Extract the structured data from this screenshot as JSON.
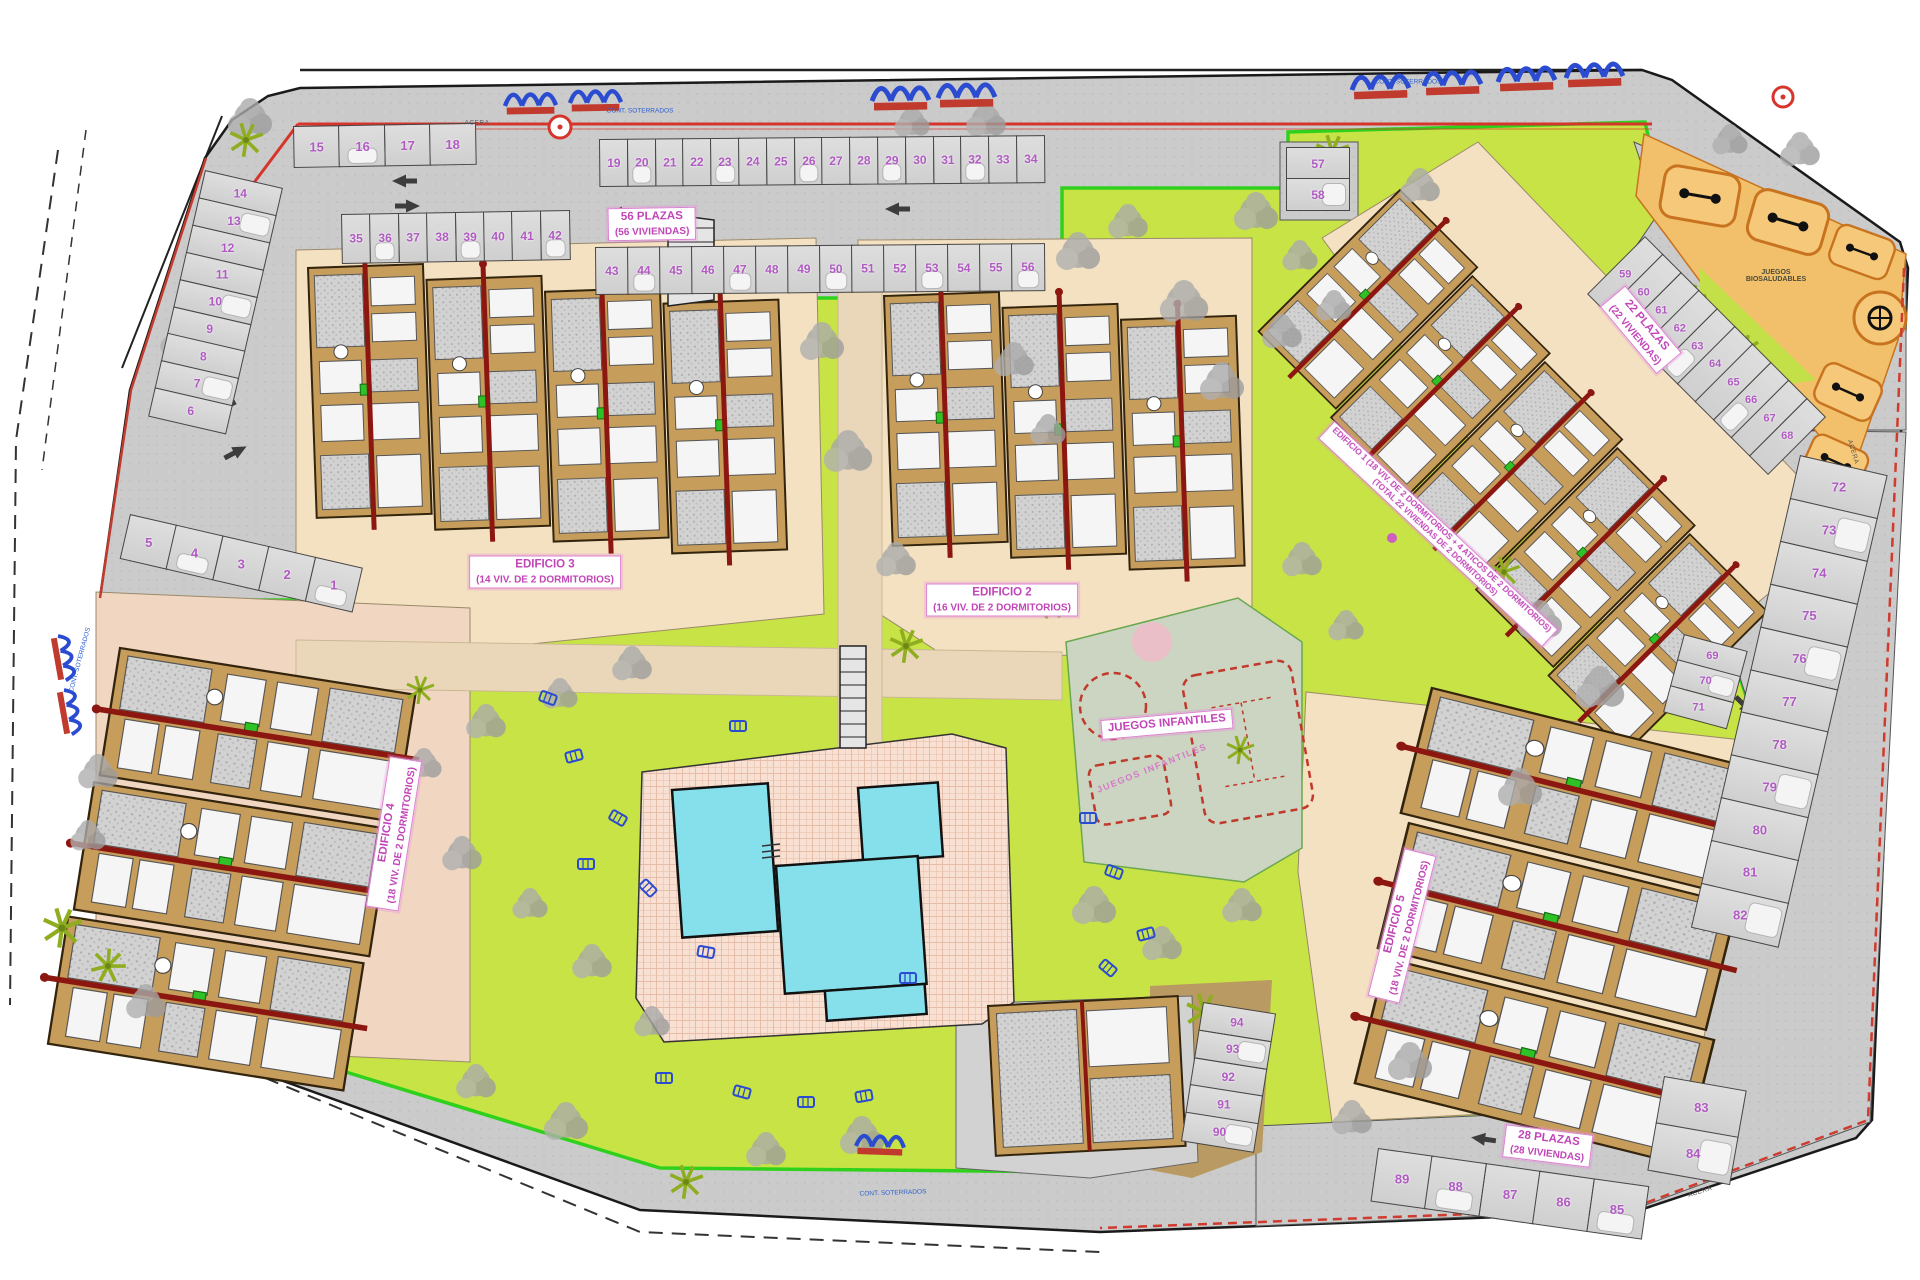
{
  "document": {
    "type": "site-plan",
    "description": "Residential development master site plan"
  },
  "labels": {
    "zone_top": {
      "line1": "56 PLAZAS",
      "line2": "(56 VIVIENDAS)"
    },
    "zone_right": {
      "line1": "22 PLAZAS",
      "line2": "(22 VIVIENDAS)"
    },
    "zone_bottom": {
      "line1": "28 PLAZAS",
      "line2": "(28 VIVIENDAS)"
    },
    "edificio1": {
      "line1": "EDIFICIO 1 (18 VIV. DE 2 DORMITORIOS + 4 ATICOS DE 2 DORMITORIOS)",
      "line2": "(TOTAL 22 VIVIENDAS DE 2 DORMITORIOS)"
    },
    "edificio2": {
      "line1": "EDIFICIO 2",
      "line2": "(16 VIV. DE 2 DORMITORIOS)"
    },
    "edificio3": {
      "line1": "EDIFICIO 3",
      "line2": "(14 VIV. DE 2 DORMITORIOS)"
    },
    "edificio4": {
      "line1": "EDIFICIO 4",
      "line2": "(18 VIV. DE 2 DORMITORIOS)"
    },
    "edificio5": {
      "line1": "EDIFICIO 5",
      "line2": "(18 VIV. DE 2 DORMITORIOS)"
    },
    "playground": "JUEGOS INFANTILES",
    "playground_small": "JUEGOS INFANTILES",
    "biosaludables": "JUEGOS BIOSALUDABLES",
    "containers": "CONT. SOTERRADOS",
    "sidewalk": "ACERA"
  },
  "parking": {
    "groups": [
      {
        "id": "top1518",
        "numbers": [
          15,
          16,
          17,
          18
        ]
      },
      {
        "id": "left14_6",
        "numbers": [
          14,
          13,
          12,
          11,
          10,
          9,
          8,
          7,
          6
        ]
      },
      {
        "id": "row1_5",
        "numbers": [
          5,
          4,
          3,
          2,
          1
        ]
      },
      {
        "id": "row19_34",
        "numbers": [
          19,
          20,
          21,
          22,
          23,
          24,
          25,
          26,
          27,
          28,
          29,
          30,
          31,
          32,
          33,
          34
        ]
      },
      {
        "id": "row35_42",
        "numbers": [
          35,
          36,
          37,
          38,
          39,
          40,
          41,
          42
        ]
      },
      {
        "id": "row43_56",
        "numbers": [
          43,
          44,
          45,
          46,
          47,
          48,
          49,
          50,
          51,
          52,
          53,
          54,
          55,
          56
        ]
      },
      {
        "id": "col57_58",
        "numbers": [
          57,
          58
        ]
      },
      {
        "id": "diag59_68",
        "numbers": [
          59,
          60,
          61,
          62,
          63,
          64,
          65,
          66,
          67,
          68
        ]
      },
      {
        "id": "col69_71",
        "numbers": [
          69,
          70,
          71
        ]
      },
      {
        "id": "right72_82",
        "numbers": [
          72,
          73,
          74,
          75,
          76,
          77,
          78,
          79,
          80,
          81,
          82
        ]
      },
      {
        "id": "right83_84",
        "numbers": [
          83,
          84
        ]
      },
      {
        "id": "bottom85_89",
        "numbers": [
          89,
          88,
          87,
          86,
          85
        ]
      },
      {
        "id": "col90_94",
        "numbers": [
          94,
          93,
          92,
          91,
          90
        ]
      }
    ]
  },
  "colors": {
    "grass": "#c8e345",
    "asphalt": "#cccccc",
    "building_tan": "#c79d5c",
    "pool_cyan": "#86e0ec",
    "courtyard_cream": "#f4e1c2",
    "stall_number": "#b05ac2",
    "label_pink": "#c245b8",
    "boundary_green": "#2fd11c",
    "boundary_red": "#d6352b",
    "gym_orange": "#f2c06a",
    "path_brown": "#b99a62",
    "furniture_blue": "#2b4bd0",
    "roof_spine_red": "#8c1710"
  },
  "icons": {
    "tree": "gray-cloud-blob",
    "palm": "lime-star",
    "sun_lounger": "blue-outline-rect",
    "traffic_arrow": "dark-gray-arrow",
    "bike_rack": "blue-arches-red-bar",
    "gym_station": "orange-rounded-box",
    "roundabout_marker": "red-ring"
  }
}
